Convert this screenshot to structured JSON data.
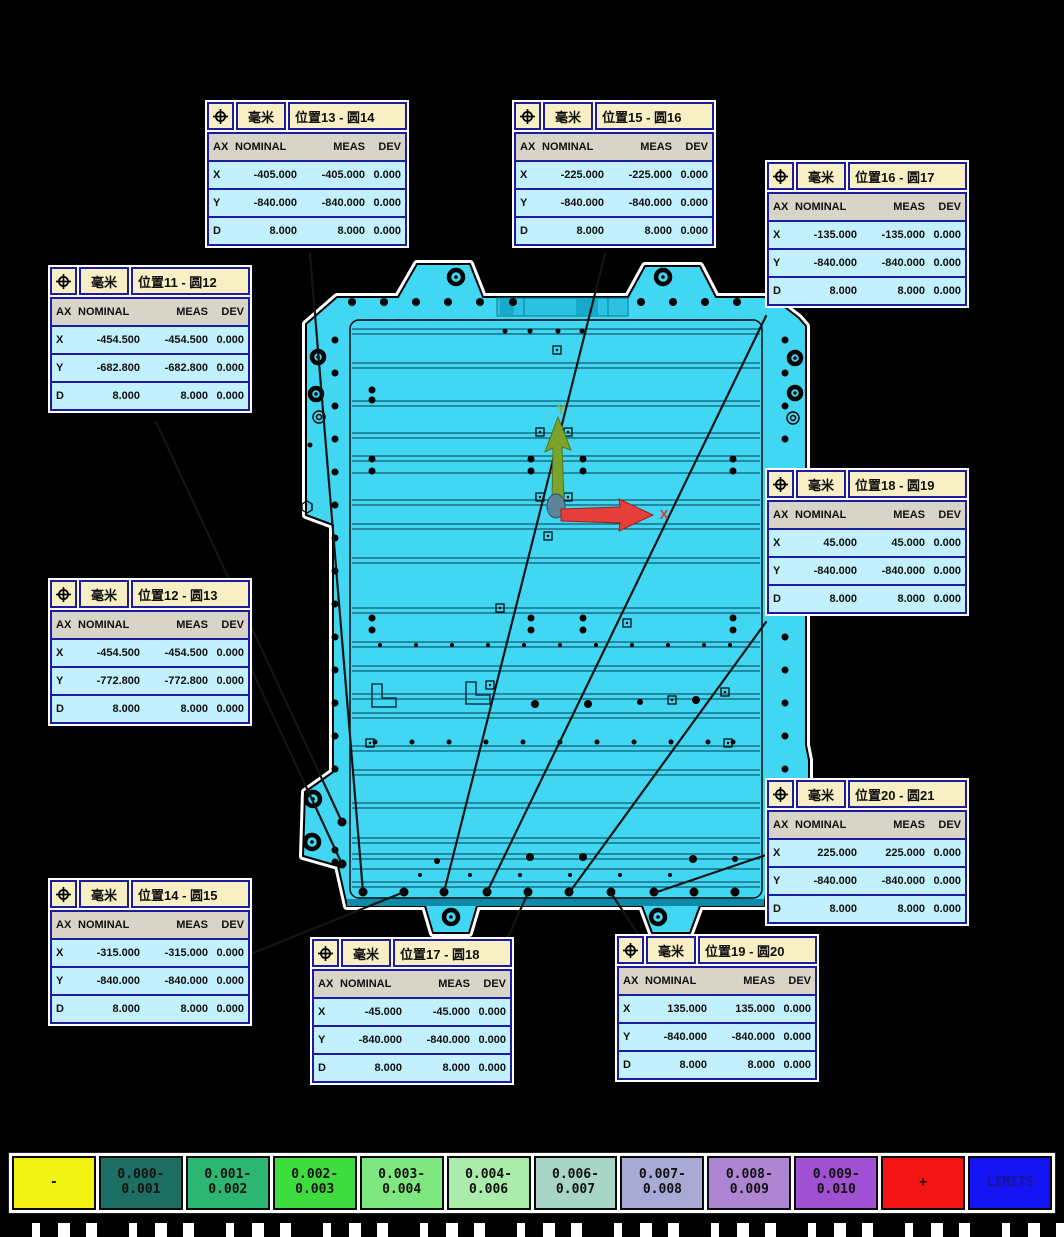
{
  "columns": [
    "AX",
    "NOMINAL",
    "MEAS",
    "DEV"
  ],
  "unit": "毫米",
  "labels": [
    {
      "title": "位置11 - 圆12",
      "unit": "毫米",
      "rows": [
        [
          "X",
          "-454.500",
          "-454.500",
          "0.000"
        ],
        [
          "Y",
          "-682.800",
          "-682.800",
          "0.000"
        ],
        [
          "D",
          "8.000",
          "8.000",
          "0.000"
        ]
      ]
    },
    {
      "title": "位置12 - 圆13",
      "unit": "毫米",
      "rows": [
        [
          "X",
          "-454.500",
          "-454.500",
          "0.000"
        ],
        [
          "Y",
          "-772.800",
          "-772.800",
          "0.000"
        ],
        [
          "D",
          "8.000",
          "8.000",
          "0.000"
        ]
      ]
    },
    {
      "title": "位置13 - 圆14",
      "unit": "毫米",
      "rows": [
        [
          "X",
          "-405.000",
          "-405.000",
          "0.000"
        ],
        [
          "Y",
          "-840.000",
          "-840.000",
          "0.000"
        ],
        [
          "D",
          "8.000",
          "8.000",
          "0.000"
        ]
      ]
    },
    {
      "title": "位置14 - 圆15",
      "unit": "毫米",
      "rows": [
        [
          "X",
          "-315.000",
          "-315.000",
          "0.000"
        ],
        [
          "Y",
          "-840.000",
          "-840.000",
          "0.000"
        ],
        [
          "D",
          "8.000",
          "8.000",
          "0.000"
        ]
      ]
    },
    {
      "title": "位置15 - 圆16",
      "unit": "毫米",
      "rows": [
        [
          "X",
          "-225.000",
          "-225.000",
          "0.000"
        ],
        [
          "Y",
          "-840.000",
          "-840.000",
          "0.000"
        ],
        [
          "D",
          "8.000",
          "8.000",
          "0.000"
        ]
      ]
    },
    {
      "title": "位置16 - 圆17",
      "unit": "毫米",
      "rows": [
        [
          "X",
          "-135.000",
          "-135.000",
          "0.000"
        ],
        [
          "Y",
          "-840.000",
          "-840.000",
          "0.000"
        ],
        [
          "D",
          "8.000",
          "8.000",
          "0.000"
        ]
      ]
    },
    {
      "title": "位置17 - 圆18",
      "unit": "毫米",
      "rows": [
        [
          "X",
          "-45.000",
          "-45.000",
          "0.000"
        ],
        [
          "Y",
          "-840.000",
          "-840.000",
          "0.000"
        ],
        [
          "D",
          "8.000",
          "8.000",
          "0.000"
        ]
      ]
    },
    {
      "title": "位置18 - 圆19",
      "unit": "毫米",
      "rows": [
        [
          "X",
          "45.000",
          "45.000",
          "0.000"
        ],
        [
          "Y",
          "-840.000",
          "-840.000",
          "0.000"
        ],
        [
          "D",
          "8.000",
          "8.000",
          "0.000"
        ]
      ]
    },
    {
      "title": "位置19 - 圆20",
      "unit": "毫米",
      "rows": [
        [
          "X",
          "135.000",
          "135.000",
          "0.000"
        ],
        [
          "Y",
          "-840.000",
          "-840.000",
          "0.000"
        ],
        [
          "D",
          "8.000",
          "8.000",
          "0.000"
        ]
      ]
    },
    {
      "title": "位置20 - 圆21",
      "unit": "毫米",
      "rows": [
        [
          "X",
          "225.000",
          "225.000",
          "0.000"
        ],
        [
          "Y",
          "-840.000",
          "-840.000",
          "0.000"
        ],
        [
          "D",
          "8.000",
          "8.000",
          "0.000"
        ]
      ]
    }
  ],
  "axis": {
    "x_label": "X",
    "y_label": "Y",
    "x_color": "#e03535",
    "y_color": "#8fae3a"
  },
  "legend": {
    "cells": [
      {
        "label": "-",
        "bg": "#f2f312"
      },
      {
        "label": "0.000-\n0.001",
        "bg": "#1e6f63"
      },
      {
        "label": "0.001-\n0.002",
        "bg": "#2db671"
      },
      {
        "label": "0.002-\n0.003",
        "bg": "#3fdc3f"
      },
      {
        "label": "0.003-\n0.004",
        "bg": "#7fe77f"
      },
      {
        "label": "0.004-\n0.006",
        "bg": "#abebab"
      },
      {
        "label": "0.006-\n0.007",
        "bg": "#a9d5c6"
      },
      {
        "label": "0.007-\n0.008",
        "bg": "#a9a9d6"
      },
      {
        "label": "0.008-\n0.009",
        "bg": "#ae85d3"
      },
      {
        "label": "0.009-\n0.010",
        "bg": "#a050d2"
      },
      {
        "label": "+",
        "bg": "#f51414"
      },
      {
        "label": "LIMITS",
        "bg": "#1414f2",
        "fg": "#16168e"
      }
    ]
  },
  "colors": {
    "part_fill": "#41d7f2",
    "part_shade": "#2cc2e2",
    "part_dark": "#0e8aa8",
    "label_border": "#1c1c9c",
    "label_header_bg": "#f8f0c4",
    "label_row_bg": "#c2f0fc",
    "label_colhead_bg": "#d8d4c8",
    "background": "#000000"
  }
}
